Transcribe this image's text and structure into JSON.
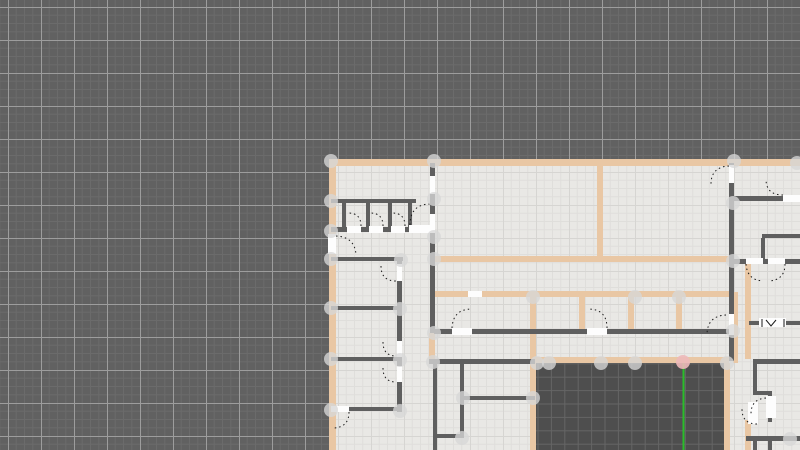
{
  "canvas": {
    "width": 800,
    "height": 450
  },
  "colors": {
    "background": "#616161",
    "bg_grid_minor": "#6b6b6b",
    "bg_grid_major": "#9d9d9d",
    "floor": "#e9e8e5",
    "floor_grid_minor": "#dfdedb",
    "floor_grid_major": "#d6d5d2",
    "courtyard": "#4e4e4e",
    "courtyard_grid": "#656565",
    "wall_tan": "#e9c7a4",
    "wall_dark": "#5f5f5f",
    "door_white": "#fdfdfd",
    "arc_black": "#1a1a1a",
    "node_gray": "#d7d7d7",
    "node_pink": "#edb9ba",
    "guide_green": "#2abd2a"
  },
  "grid": {
    "bg_minor_step": 8.25,
    "bg_major_step": 33,
    "bg_offset_x": 8,
    "bg_offset_y": 7,
    "floor_minor_step": 8.25,
    "floor_major_step": 33,
    "courtyard_step": 13.4
  },
  "floor_rect": {
    "x": 331,
    "y": 159,
    "w": 469,
    "h": 291
  },
  "courtyard_rect": {
    "x": 536,
    "y": 362,
    "w": 188,
    "h": 88
  },
  "walls_tan": [
    [
      331,
      159,
      469,
      7
    ],
    [
      434,
      256,
      299,
      6
    ],
    [
      434,
      291,
      299,
      6
    ],
    [
      533,
      357,
      196,
      6
    ],
    [
      329,
      159,
      7,
      76
    ],
    [
      329,
      254,
      7,
      196
    ],
    [
      597,
      165,
      6,
      91
    ],
    [
      579,
      297,
      6,
      33
    ],
    [
      628,
      297,
      6,
      33
    ],
    [
      676,
      297,
      6,
      33
    ],
    [
      530,
      292,
      6,
      158
    ],
    [
      724,
      363,
      6,
      87
    ],
    [
      733,
      292,
      5,
      71
    ],
    [
      745,
      263,
      6,
      96
    ],
    [
      745,
      420,
      6,
      30
    ],
    [
      429,
      333,
      6,
      26
    ]
  ],
  "walls_dark": [
    [
      331,
      199,
      85,
      4
    ],
    [
      342,
      203,
      4,
      25
    ],
    [
      366,
      203,
      4,
      25
    ],
    [
      388,
      203,
      4,
      25
    ],
    [
      408,
      203,
      4,
      25
    ],
    [
      331,
      227,
      102,
      5
    ],
    [
      430,
      163,
      5,
      95
    ],
    [
      331,
      257,
      72,
      4
    ],
    [
      397,
      261,
      5,
      151
    ],
    [
      331,
      306,
      69,
      4
    ],
    [
      331,
      357,
      69,
      4
    ],
    [
      331,
      407,
      69,
      4
    ],
    [
      430,
      258,
      5,
      75
    ],
    [
      433,
      361,
      4,
      89
    ],
    [
      460,
      361,
      4,
      77
    ],
    [
      433,
      434,
      31,
      4
    ],
    [
      462,
      396,
      73,
      4
    ],
    [
      429,
      359,
      106,
      5
    ],
    [
      434,
      329,
      298,
      5
    ],
    [
      729,
      163,
      5,
      198
    ],
    [
      734,
      196,
      66,
      5
    ],
    [
      762,
      234,
      38,
      4
    ],
    [
      761,
      238,
      4,
      23
    ],
    [
      734,
      259,
      66,
      5
    ],
    [
      749,
      321,
      51,
      4
    ],
    [
      753,
      359,
      47,
      5
    ],
    [
      753,
      364,
      4,
      29
    ],
    [
      753,
      391,
      19,
      4
    ],
    [
      768,
      395,
      4,
      27
    ],
    [
      746,
      436,
      54,
      5
    ],
    [
      753,
      441,
      4,
      9
    ],
    [
      768,
      441,
      4,
      9
    ]
  ],
  "door_gaps": [
    [
      347,
      226,
      14,
      7
    ],
    [
      369,
      226,
      14,
      7
    ],
    [
      391,
      226,
      14,
      7
    ],
    [
      409,
      225,
      22,
      8
    ],
    [
      328,
      234,
      8,
      20
    ],
    [
      430,
      176,
      5,
      18
    ],
    [
      430,
      214,
      5,
      19
    ],
    [
      397,
      264,
      5,
      17
    ],
    [
      397,
      341,
      5,
      16
    ],
    [
      397,
      366,
      5,
      16
    ],
    [
      452,
      328,
      20,
      7
    ],
    [
      587,
      328,
      20,
      7
    ],
    [
      468,
      291,
      14,
      6
    ],
    [
      331,
      406,
      18,
      6
    ],
    [
      729,
      165,
      5,
      18
    ],
    [
      729,
      314,
      5,
      21
    ],
    [
      783,
      195,
      17,
      7
    ],
    [
      746,
      258,
      17,
      6
    ],
    [
      768,
      258,
      17,
      6
    ],
    [
      766,
      396,
      10,
      22
    ],
    [
      748,
      402,
      10,
      22
    ]
  ],
  "door_arcs": [
    "M361 226 Q361 213 348 213",
    "M383 226 Q383 213 370 213",
    "M405 226 Q405 213 392 213",
    "M410 225 Q410 204 431 204",
    "M336 236 Q355 237 356 255",
    "M381 266 Q381 281 396 281",
    "M452 328 Q453 309 472 309",
    "M607 328 Q607 309 588 309",
    "M383 342 Q383 356 396 356",
    "M383 368 Q383 382 396 382",
    "M349 412 Q349 427 334 428",
    "M729 166 Q711 167 711 184",
    "M783 195 Q766 195 766 179",
    "M746 264 Q747 280 763 281",
    "M785 264 Q785 280 769 281",
    "M726 315 Q707 316 707 335",
    "M766 398 Q751 399 751 414",
    "M757 424 Q742 424 742 409"
  ],
  "window": {
    "rect": [
      759,
      318,
      27,
      9
    ],
    "marks": [
      "M762 319 L762 327",
      "M784 319 L784 327",
      "M766 320 L771 326 L776 320"
    ]
  },
  "nodes": [
    [
      331,
      161
    ],
    [
      434,
      161
    ],
    [
      734,
      161
    ],
    [
      797,
      163
    ],
    [
      331,
      201
    ],
    [
      331,
      231
    ],
    [
      331,
      259
    ],
    [
      331,
      308
    ],
    [
      331,
      359
    ],
    [
      331,
      410
    ],
    [
      434,
      199
    ],
    [
      434,
      237
    ],
    [
      434,
      259
    ],
    [
      401,
      260
    ],
    [
      400,
      309
    ],
    [
      400,
      360
    ],
    [
      400,
      411
    ],
    [
      433,
      362
    ],
    [
      463,
      398
    ],
    [
      533,
      398
    ],
    [
      533,
      297
    ],
    [
      537,
      363
    ],
    [
      549,
      363
    ],
    [
      601,
      363
    ],
    [
      635,
      363
    ],
    [
      727,
      363
    ],
    [
      733,
      203
    ],
    [
      733,
      261
    ],
    [
      733,
      331
    ],
    [
      790,
      439
    ],
    [
      635,
      297
    ],
    [
      679,
      297
    ],
    [
      434,
      333
    ],
    [
      462,
      438
    ]
  ],
  "highlight_node": [
    683,
    362
  ],
  "guide_line": {
    "x": 683.5,
    "y1": 363,
    "y2": 450
  }
}
